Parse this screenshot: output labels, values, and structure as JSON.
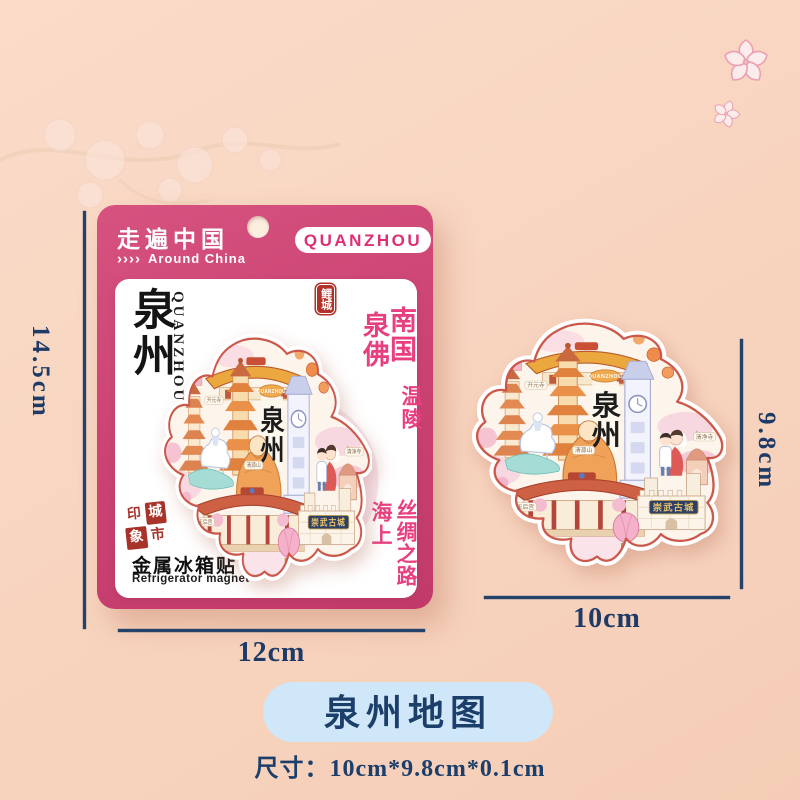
{
  "card": {
    "brand_title": "走遍中国",
    "brand_chevrons": "››››",
    "brand_subtitle": "Around China",
    "city_pill_label": "QUANZHOU",
    "panel": {
      "city_name_vertical": "泉州",
      "city_name_latin": "QUANZHOU",
      "badge_licheng": "鲤城",
      "slogan_col_right": "南国",
      "slogan_col_left": "泉佛",
      "slogan_wenling": "温陵",
      "slogan_haishang": "海上",
      "slogan_silk_road": "丝绸之路",
      "seal_chars": {
        "c1": "印",
        "c2": "城",
        "c3": "象",
        "c4": "市"
      },
      "product_name_cn": "金属冰箱贴",
      "product_name_en": "Refrigerator magnet"
    }
  },
  "magnet": {
    "title_tag": "QUANZHOU",
    "title_char1": "泉",
    "title_char2": "州",
    "castle_banner": "崇武古城",
    "label_kaiyuan": "开元寺",
    "label_qingyuan": "清源山",
    "label_qingjing": "清净寺",
    "label_tianhou": "天后宫"
  },
  "dimensions": {
    "card_height": "14.5cm",
    "card_width": "12cm",
    "magnet_height": "9.8cm",
    "magnet_width": "10cm"
  },
  "caption": {
    "product_title": "泉州地图",
    "size_label": "尺寸：10cm*9.8cm*0.1cm"
  },
  "colors": {
    "background": "#f8d5c0",
    "card_pink": "#cc4474",
    "slogan_pink": "#e83f80",
    "seal_red": "#a8332a",
    "dimension_navy": "#1e3a66",
    "caption_blue_bg": "#cfe7f8",
    "caption_navy": "#1c3e6b"
  }
}
